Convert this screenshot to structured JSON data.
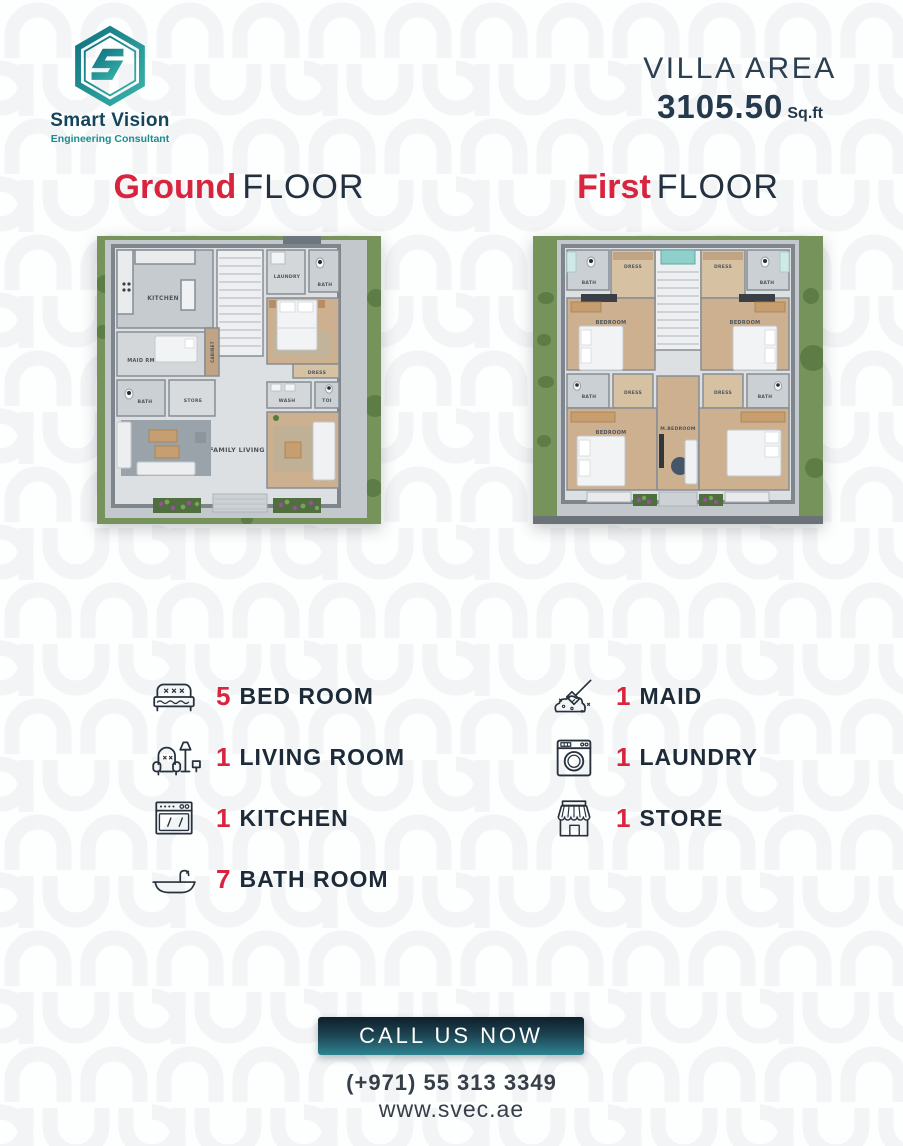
{
  "brand": {
    "name": "Smart Vision",
    "tagline": "Engineering Consultant",
    "logo_icon": "hexagon-s-logo"
  },
  "header": {
    "villa_area_label": "VILLA AREA",
    "villa_area_value": "3105.50",
    "villa_area_unit": "Sq.ft"
  },
  "floor_plans": {
    "ground": {
      "heading_accent": "Ground",
      "heading_rest": "FLOOR",
      "room_labels": {
        "kitchen": "KITCHEN",
        "laundry": "LAUNDRY",
        "bath_top": "BATH",
        "maid": "MAID RM",
        "cabinet": "CABINET",
        "bath_left": "BATH",
        "store": "STORE",
        "dress": "DRESS",
        "wash": "WASH",
        "toilet": "TOI",
        "family_living": "FAMILY LIVING"
      }
    },
    "first": {
      "heading_accent": "First",
      "heading_rest": "FLOOR",
      "room_labels": {
        "bath_tl": "BATH",
        "dress_tl": "DRESS",
        "dress_tr": "DRESS",
        "bath_tr": "BATH",
        "bedroom_tl": "BEDROOM",
        "bedroom_tr": "BEDROOM",
        "bath_ml": "BATH",
        "dress_ml": "DRESS",
        "dress_mr": "DRESS",
        "bath_mr": "BATH",
        "bedroom_bl": "BEDROOM",
        "master_bedroom": "M.BEDROOM"
      }
    }
  },
  "features": {
    "left": [
      {
        "icon": "bed-icon",
        "count": "5",
        "label": "BED ROOM"
      },
      {
        "icon": "living-room-icon",
        "count": "1",
        "label": "LIVING ROOM"
      },
      {
        "icon": "kitchen-icon",
        "count": "1",
        "label": "KITCHEN"
      },
      {
        "icon": "bath-icon",
        "count": "7",
        "label": "BATH ROOM"
      }
    ],
    "right": [
      {
        "icon": "maid-icon",
        "count": "1",
        "label": "MAID"
      },
      {
        "icon": "laundry-icon",
        "count": "1",
        "label": "LAUNDRY"
      },
      {
        "icon": "store-icon",
        "count": "1",
        "label": "STORE"
      }
    ]
  },
  "contact": {
    "button_label": "CALL US NOW",
    "phone": "(+971) 55 313 3349",
    "website": "www.svec.ae"
  },
  "colors": {
    "accent_red": "#d8243e",
    "dark_navy": "#22303f",
    "teal": "#1d8d8d",
    "button_gradient_top": "#0f1f2b",
    "button_gradient_bottom": "#2e8391"
  }
}
